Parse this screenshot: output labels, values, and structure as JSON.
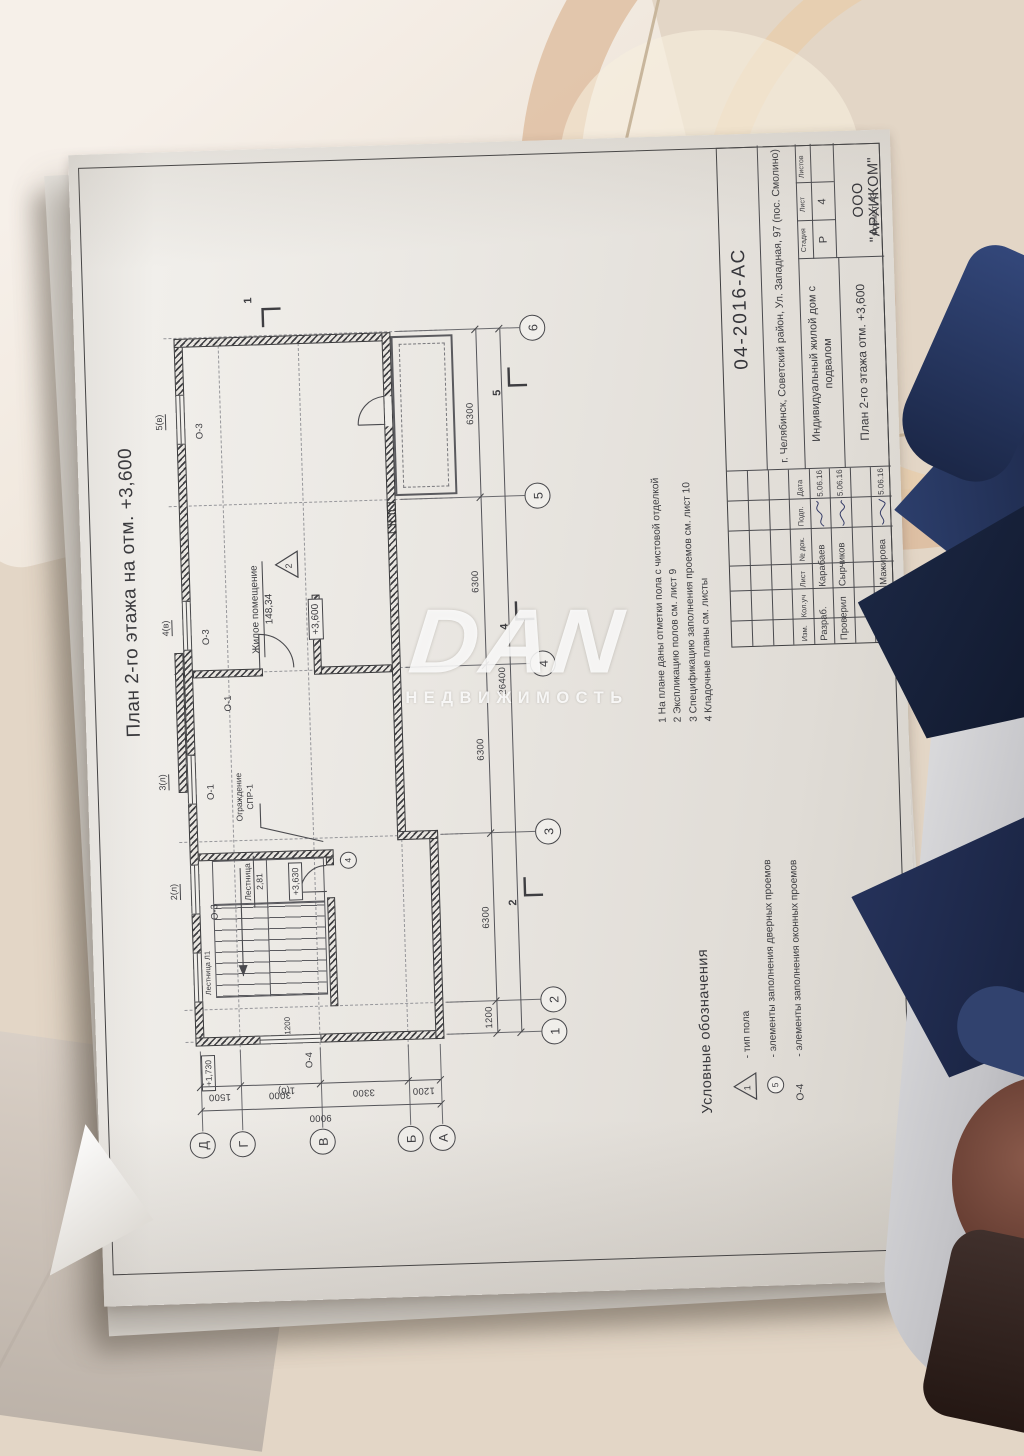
{
  "watermark": {
    "brand": "DAN",
    "subtitle": "НЕДВИЖИМОСТЬ"
  },
  "sheet": {
    "title": "План 2-го этажа на отм. +3,600",
    "format_note": "Формат А3",
    "notes": {
      "n1": "1  На плане даны отметки пола с чистовой отделкой",
      "n2": "2  Экспликацию полов см. лист 9",
      "n3": "3  Спецификацию заполнения проемов см. лист 10",
      "n4": "4  Кладочные планы см. листы"
    },
    "legend": {
      "header": "Условные обозначения",
      "floor_symbol": "1",
      "floor_text": "-  тип пола",
      "door_symbol": "5",
      "door_text": "-  элементы заполнения дверных проемов",
      "window_symbol": "О-4",
      "window_text": "-  элементы заполнения оконных проемов"
    }
  },
  "plan": {
    "rooms": {
      "living_name": "Жилое помещение",
      "living_area": "148,34",
      "living_level": "+3,600",
      "stair_name": "Лестница",
      "stair_area": "2,81",
      "stair_level": "+3,630",
      "stair_id": "Лестница Л1",
      "entry_level": "+1,730",
      "railing_line1": "Ограждение",
      "railing_line2": "СПР-1"
    },
    "floor_type": "2",
    "door_mark": "4",
    "window_labels": {
      "o3": "О-3",
      "o1": "О-1",
      "o4": "О-4"
    },
    "opening_marks": {
      "m1": "1(б)",
      "m2": "2(л)",
      "m3": "3(л)",
      "m4": "4(в)",
      "m5": "5(в)"
    },
    "section_marks": {
      "s1": "1",
      "s2": "2",
      "s4": "4",
      "s5": "5"
    },
    "axes_numeric": [
      "1",
      "2",
      "3",
      "4",
      "5",
      "6"
    ],
    "axes_letters": [
      "А",
      "Б",
      "В",
      "Г",
      "Д"
    ],
    "dims_bottom": [
      "1200",
      "6300",
      "6300",
      "6300",
      "6300"
    ],
    "dims_bottom_total": "26400",
    "dims_left": [
      "1500",
      "3000",
      "3300",
      "1200"
    ],
    "dims_left_total": "9000",
    "dim_stair": "1200"
  },
  "titleblock": {
    "doc_number": "04-2016-АС",
    "address": "г. Челябинск, Советский район, Ул. Западная, 97 (пос. Смолино)",
    "project": "Индивидуальный жилой дом с подвалом",
    "sheet_name": "План 2-го этажа отм. +3,600",
    "company": "ООО \"АРХИКОМ\"",
    "stage_label": "Стадия",
    "sheet_label": "Лист",
    "sheets_label": "Листов",
    "stage": "Р",
    "sheet_no": "4",
    "col_izm": "Изм.",
    "col_koluch": "Кол.уч",
    "col_list": "Лист",
    "col_ndok": "№ док.",
    "col_podp": "Подп.",
    "col_data": "Дата",
    "row1_role": "Разраб.",
    "row1_name": "Карабаев",
    "row1_date": "5.06.16",
    "row2_role": "Проверил",
    "row2_name": "Сырчиков",
    "row2_date": "5.06.16",
    "row3_role": "Н.контр.",
    "row3_name": "Мажирова",
    "row3_date": "5.06.16"
  }
}
